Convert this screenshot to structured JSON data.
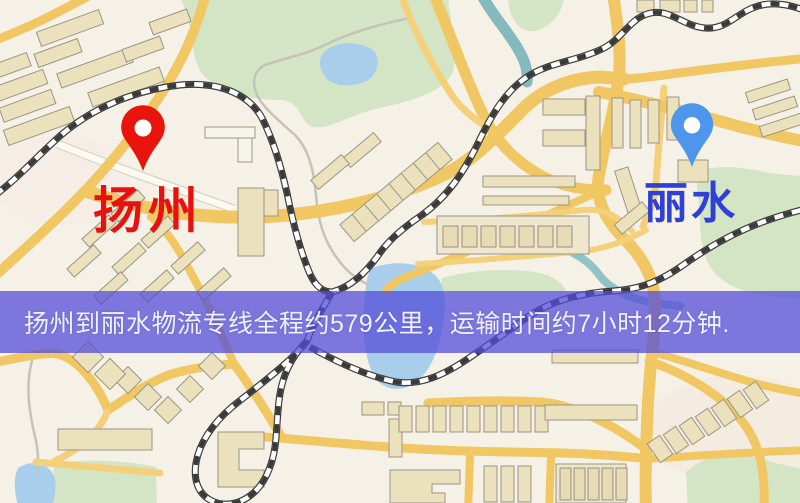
{
  "map": {
    "banner": {
      "text": "扬州到丽水物流专线全程约579公里，运输时间约7小时12分钟.",
      "background": "#544ed9",
      "text_color": "#f2f1fb",
      "distance": "约579公里",
      "duration": "约7小时12分钟"
    },
    "origin": {
      "name": "扬州",
      "label_color": "#e71210",
      "pin_color": "#e9140b"
    },
    "destination": {
      "name": "丽水",
      "label_color": "#2e41d4",
      "pin_color": "#4e96ec"
    }
  }
}
